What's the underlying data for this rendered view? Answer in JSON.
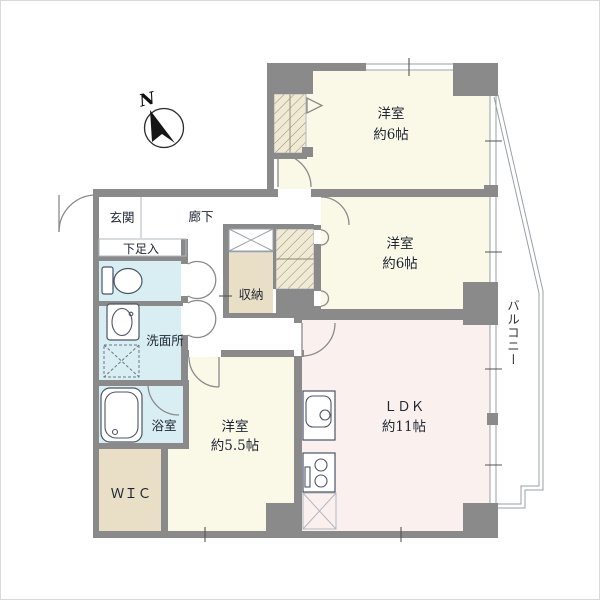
{
  "plan": {
    "compass_label": "N",
    "balcony_label": "バルコニー"
  },
  "rooms": {
    "bedroom_top": {
      "name": "洋室",
      "size": "約6帖"
    },
    "bedroom_mid": {
      "name": "洋室",
      "size": "約6帖"
    },
    "ldk": {
      "name": "ＬＤＫ",
      "size": "約11帖"
    },
    "bedroom_small": {
      "name": "洋室",
      "size": "約5.5帖"
    },
    "wic": {
      "name": "ＷＩＣ"
    },
    "bathroom": {
      "name": "浴室"
    },
    "washroom": {
      "name": "洗面所"
    },
    "entrance": {
      "name": "玄関"
    },
    "hallway": {
      "name": "廊下"
    },
    "shoe_cabinet": {
      "name": "下足入"
    },
    "storage": {
      "name": "収納"
    }
  },
  "colors": {
    "wall": "#8a8a8a",
    "room": "#faf8e6",
    "ldk": "#faf1ee",
    "wet": "#d9eef3",
    "closet": "#e9dfc7",
    "hatch_base": "#f0e9d3",
    "text": "#1d2433"
  }
}
